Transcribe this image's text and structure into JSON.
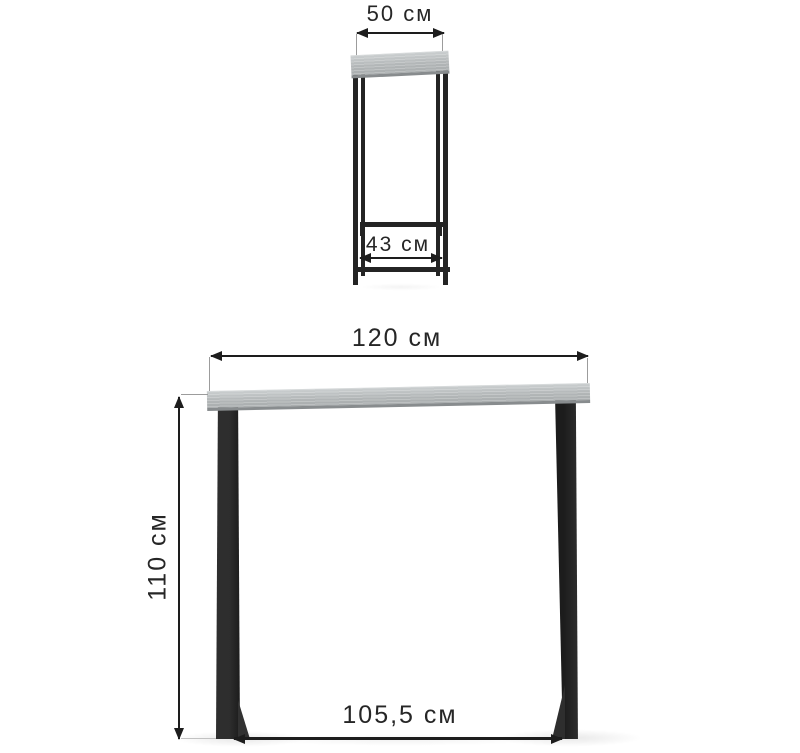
{
  "diagram": {
    "type": "product-dimension-diagram",
    "unit": "см",
    "side_view": {
      "top_width": {
        "label": "50 см",
        "value": 50,
        "unit": "см"
      },
      "base_depth": {
        "label": "43 см",
        "value": 43,
        "unit": "см"
      }
    },
    "front_view": {
      "top_width": {
        "label": "120 см",
        "value": 120,
        "unit": "см"
      },
      "height": {
        "label": "110 см",
        "value": 110,
        "unit": "см"
      },
      "base_width": {
        "label": "105,5 см",
        "value": 105.5,
        "unit": "см"
      }
    },
    "colors": {
      "dimension_line": "#1d1d1d",
      "extension_line": "#9c9c9c",
      "metal_frame": "#242424",
      "tabletop_light": "#ccd0d1",
      "tabletop_dark": "#a9adae"
    }
  }
}
